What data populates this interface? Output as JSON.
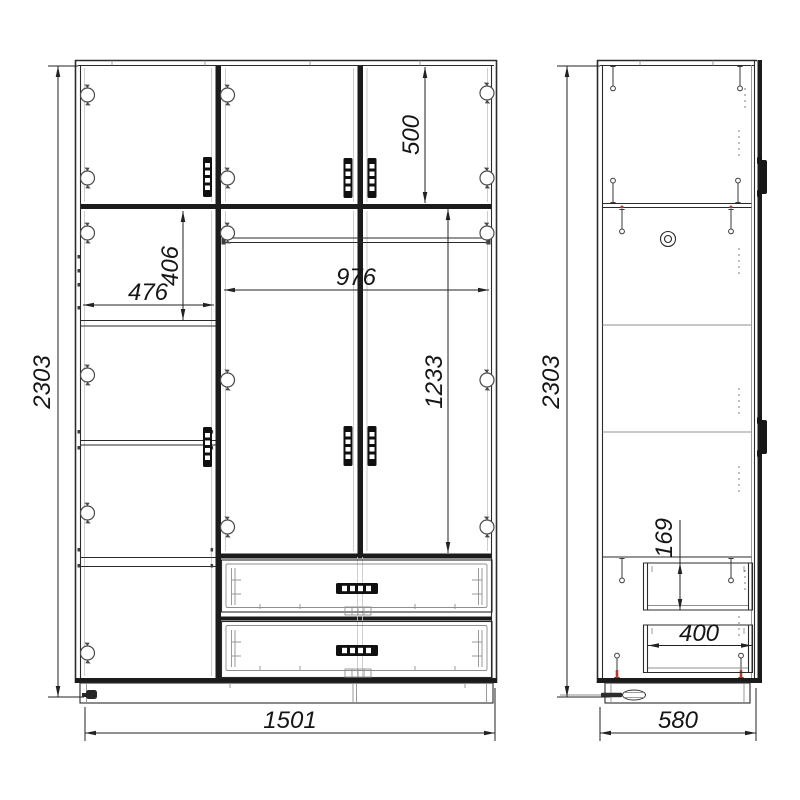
{
  "drawing": {
    "type": "furniture-assembly-drawing",
    "views": {
      "front": {
        "label": "front-view",
        "dims": {
          "overall_height_mm": "2303",
          "overall_width_mm": "1501",
          "top_doors_height_mm": "500",
          "left_section_width_mm": "476",
          "left_top_compartment_height_mm": "406",
          "center_section_width_mm": "976",
          "center_doors_height_mm": "1233"
        }
      },
      "side": {
        "label": "side-view",
        "dims": {
          "overall_height_mm": "2303",
          "overall_depth_mm": "580",
          "drawer_front_height_mm": "169",
          "drawer_depth_mm": "400"
        }
      }
    },
    "colors": {
      "background": "#ffffff",
      "line": "#1c1c1c",
      "thin_line": "#8f8f8f",
      "accent_red": "#b23a2e"
    },
    "icons": [
      "hinge-icon",
      "door-handle-icon",
      "drawer-handle-icon",
      "screw-icon",
      "cam-lock-icon",
      "screwdriver-icon",
      "adjustable-foot-icon"
    ]
  }
}
